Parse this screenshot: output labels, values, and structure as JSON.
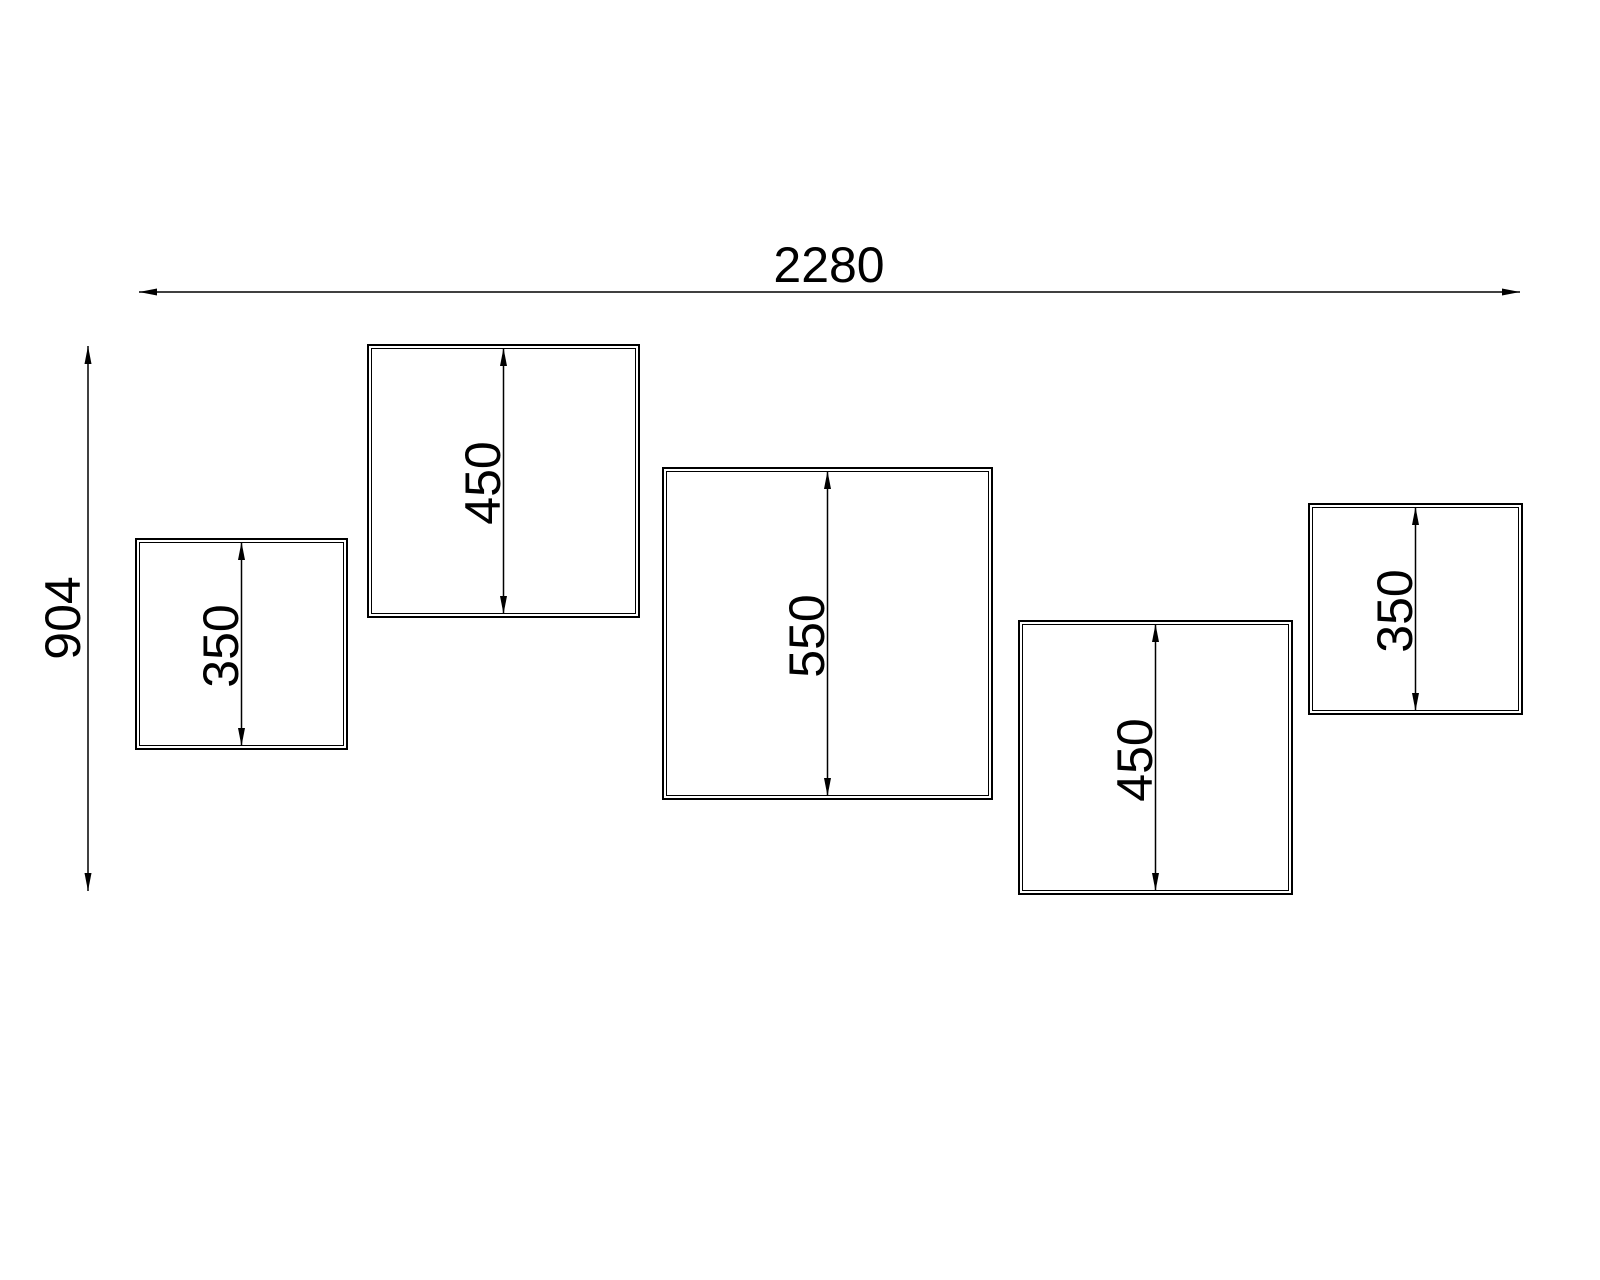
{
  "drawing": {
    "bg_color": "#ffffff",
    "line_color": "#000000",
    "overall_width_dim": {
      "value": "2280",
      "x1": 139,
      "x2": 1520,
      "y": 292,
      "label_cx": 829,
      "label_cy": 265
    },
    "overall_height_dim": {
      "value": "904",
      "x": 88,
      "y1": 346,
      "y2": 891,
      "label_cx": 63,
      "label_cy": 618
    },
    "panels": [
      {
        "value": "350",
        "x": 135,
        "y": 538,
        "w": 213,
        "h": 212
      },
      {
        "value": "450",
        "x": 367,
        "y": 344,
        "w": 273,
        "h": 274
      },
      {
        "value": "550",
        "x": 662,
        "y": 467,
        "w": 331,
        "h": 333
      },
      {
        "value": "450",
        "x": 1018,
        "y": 620,
        "w": 275,
        "h": 275
      },
      {
        "value": "350",
        "x": 1308,
        "y": 503,
        "w": 215,
        "h": 212
      }
    ]
  }
}
